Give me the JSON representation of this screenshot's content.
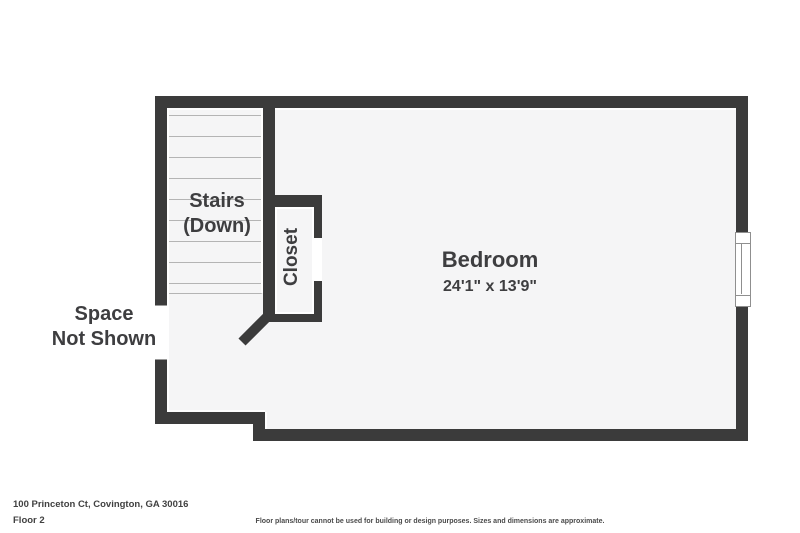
{
  "floorplan": {
    "footer": {
      "address": "100 Princeton Ct, Covington, GA 30016",
      "floor_label": "Floor 2",
      "disclaimer": "Floor plans/tour cannot be used for building or design purposes. Sizes and dimensions are approximate."
    },
    "rooms": {
      "bedroom": {
        "name": "Bedroom",
        "dimensions": "24'1\" x 13'9\""
      },
      "stairs": {
        "line1": "Stairs",
        "line2": "(Down)"
      },
      "closet": {
        "name": "Closet"
      },
      "space_not_shown": {
        "line1": "Space",
        "line2": "Not Shown"
      }
    },
    "colors": {
      "wall": "#3b3b3b",
      "floor": "#f5f5f6",
      "tread_line": "#b4b4b4",
      "text": "#3e3e40",
      "background": "#ffffff"
    }
  }
}
